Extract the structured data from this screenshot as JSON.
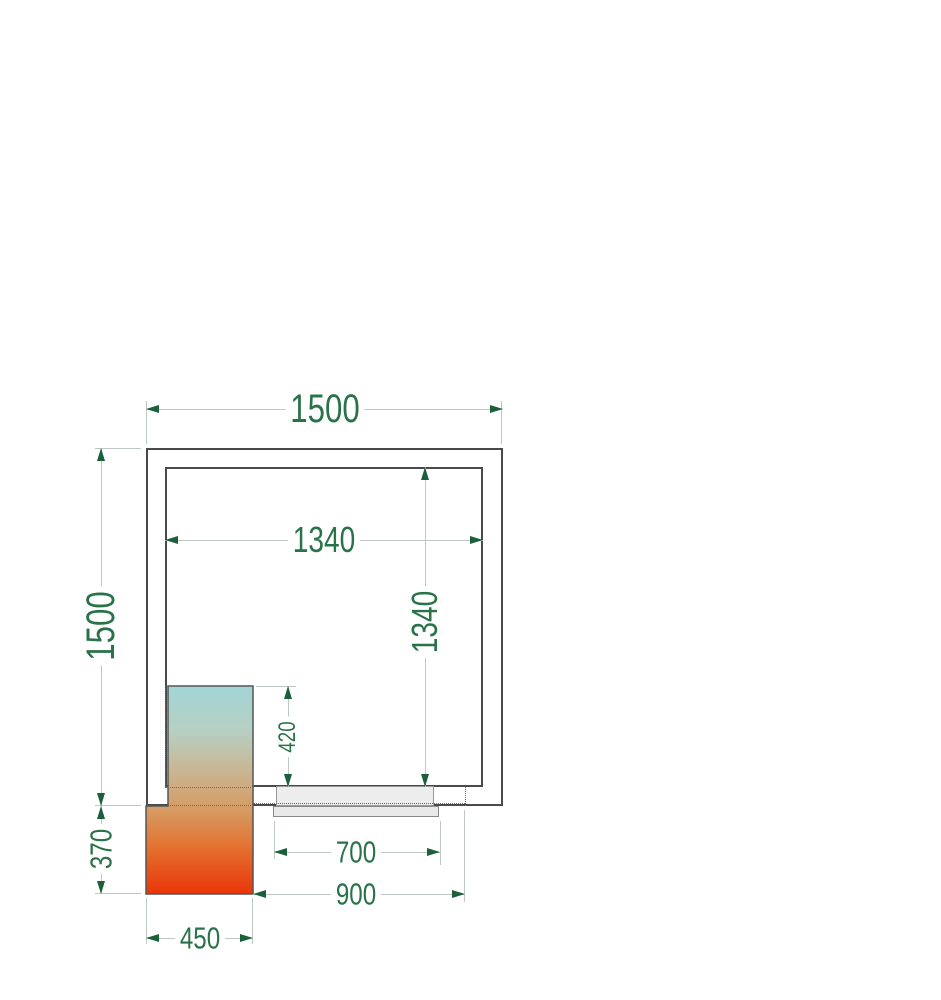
{
  "drawing": {
    "type": "cold-room-floor-plan",
    "labels": {
      "outer_width": "1500",
      "outer_depth": "1500",
      "inner_width": "1340",
      "inner_depth": "1340",
      "unit_inside_depth": "420",
      "door_width": "700",
      "door_outer_span": "900",
      "unit_width": "450",
      "unit_outside_depth": "370"
    },
    "colors": {
      "dimension_text": "#2a7249",
      "dimension_arrow": "#1c5f3b",
      "dimension_line": "#bfc7c2",
      "wall_line": "#4a4a4a",
      "door_fill": "#ededed",
      "unit_outline": "#555555",
      "unit_gradient": [
        "#a2d5d6",
        "#b7cfc2",
        "#c8b795",
        "#d69a62",
        "#e4702f",
        "#ea3509"
      ]
    }
  }
}
